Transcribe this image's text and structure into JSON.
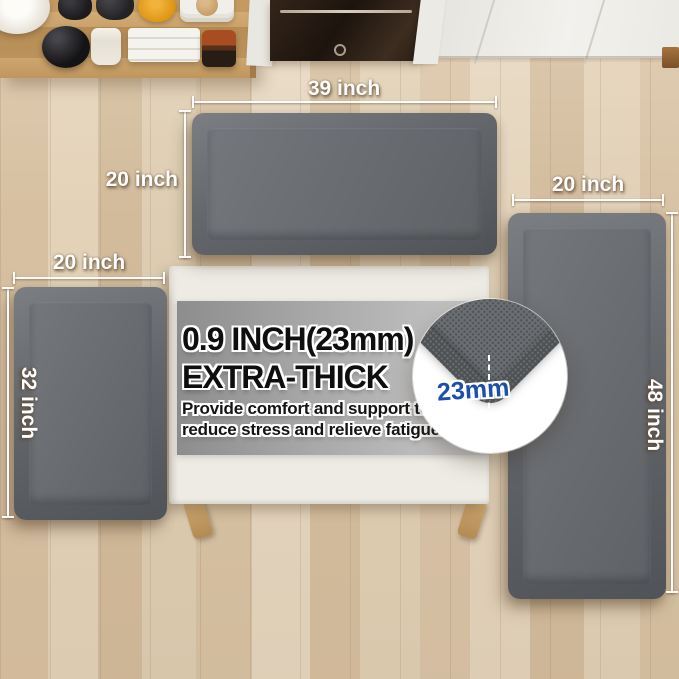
{
  "annotations": {
    "top_mat": {
      "width_label": "39 inch",
      "height_label": "20 inch"
    },
    "left_mat": {
      "width_label": "20 inch",
      "height_label": "32 inch"
    },
    "right_mat": {
      "width_label": "20 inch",
      "height_label": "48 inch"
    }
  },
  "callout": {
    "title_line1": "0.9 INCH(23mm)",
    "title_line2": "EXTRA-THICK",
    "body_line1": "Provide comfort and support to",
    "body_line2": "reduce stress and relieve fatigue.",
    "thickness_label": "23mm"
  },
  "colors": {
    "mat_surface": "#6a6d71",
    "mat_edge": "#56595c",
    "floor_wood": "#dcc7aa",
    "shelf_wood": "#c59c64",
    "table_top": "#edebe4",
    "banner_gray_left": "#8d8d8e",
    "banner_gray_right": "#c8c8c8",
    "dimension_text": "#ffffff",
    "thickness_text": "#1c4fa9",
    "headline_text": "#0e0e0e"
  }
}
